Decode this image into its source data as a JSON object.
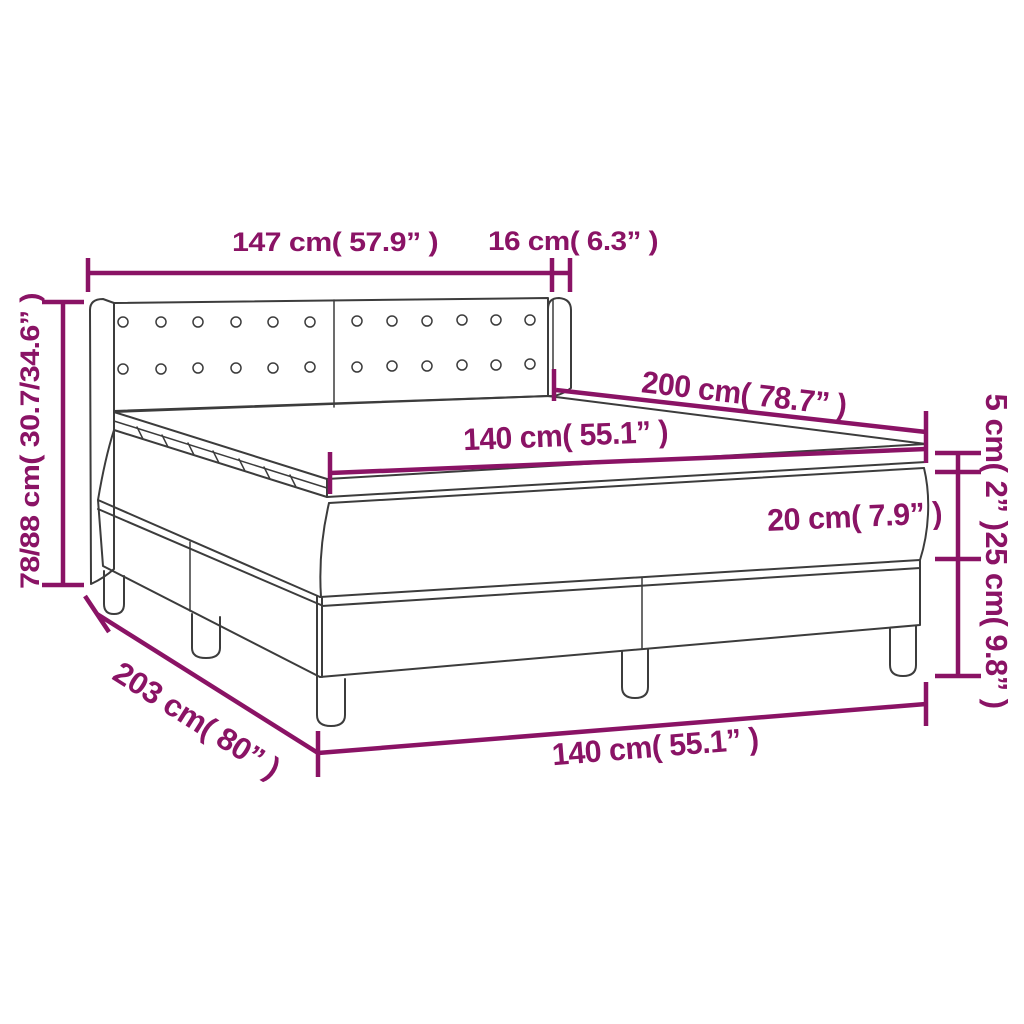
{
  "title": "Box spring bed with mattress — dimension diagram",
  "colors": {
    "accent": "#8a1365",
    "line": "#3c3c3c",
    "background": "#ffffff"
  },
  "bed": {
    "headboard_panels": 2,
    "button_rows": 2,
    "buttons_per_row": 12,
    "base_sections": 2,
    "legs_visible": 5
  },
  "dimensions": {
    "headboard_width": {
      "label": "147 cm( 57.9” )",
      "cm": "147",
      "inches": "57.9"
    },
    "wing_width": {
      "label": "16 cm( 6.3” )",
      "cm": "16",
      "inches": "6.3"
    },
    "total_height": {
      "label": "78/88 cm( 30.7/34.6” )",
      "cm": "78/88",
      "inches": "30.7/34.6"
    },
    "bed_length": {
      "label": "200 cm( 78.7” )",
      "cm": "200",
      "inches": "78.7"
    },
    "mattress_width": {
      "label": "140 cm( 55.1” )",
      "cm": "140",
      "inches": "55.1"
    },
    "topper_height": {
      "label": "5 cm( 2” )",
      "cm": "5",
      "inches": "2"
    },
    "mattress_height": {
      "label": "20 cm( 7.9” )",
      "cm": "20",
      "inches": "7.9"
    },
    "base_height": {
      "label": "25 cm( 9.8” )",
      "cm": "25",
      "inches": "9.8"
    },
    "base_length": {
      "label": "203 cm( 80” )",
      "cm": "203",
      "inches": "80"
    },
    "base_width": {
      "label": "140 cm( 55.1” )",
      "cm": "140",
      "inches": "55.1"
    }
  }
}
